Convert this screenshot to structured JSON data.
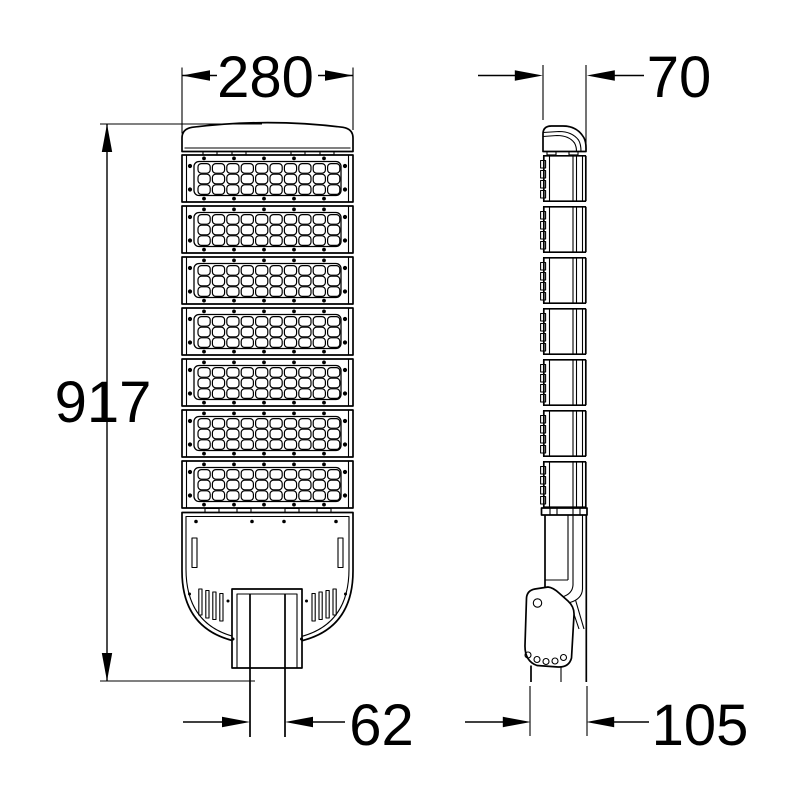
{
  "drawing": {
    "type": "technical-dimension-drawing",
    "subject": "LED street light - front and side elevation views",
    "background_color": "#ffffff",
    "line_color": "#000000"
  },
  "front_view": {
    "width_mm": "280",
    "height_mm": "917",
    "mount_width_mm": "62",
    "led_module_count": 7,
    "lens_columns": 10,
    "lens_rows_per_module": 3
  },
  "side_view": {
    "width_mm": "70",
    "mount_depth_mm": "105"
  }
}
